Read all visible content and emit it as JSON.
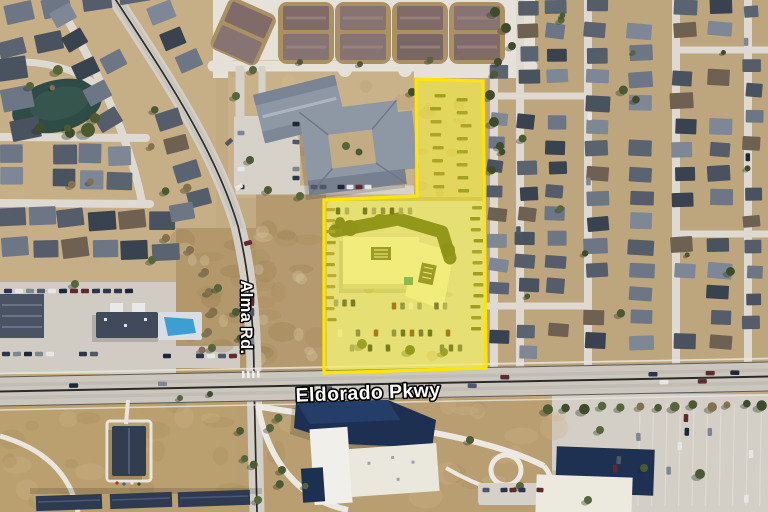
{
  "map": {
    "labels": {
      "alma_rd": "Alma Rd.",
      "eldorado_pkwy": "Eldorado Pkwy"
    },
    "label_style": {
      "fill": "#FFFFFF",
      "outline": "#000000"
    },
    "parcel_highlight": {
      "fill": "#FFF200",
      "fill_opacity": "0.42",
      "stroke": "#FFE600",
      "stroke_width": "3.2"
    }
  }
}
